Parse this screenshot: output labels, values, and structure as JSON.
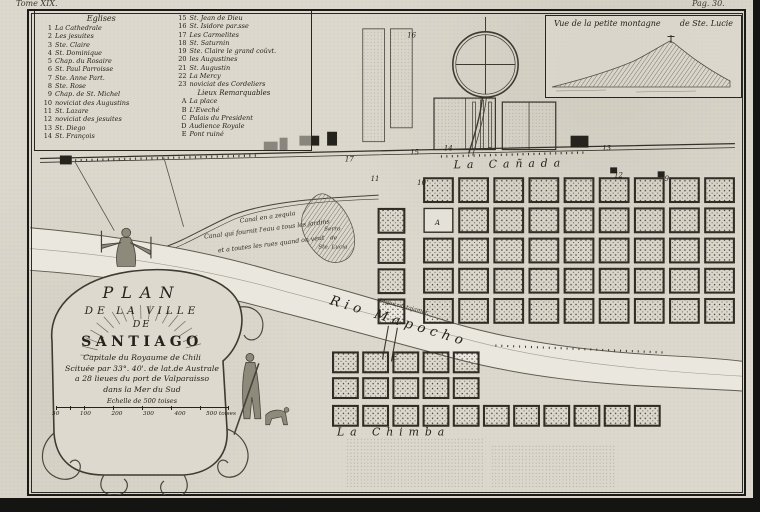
{
  "page": {
    "tome": "Tome XIX.",
    "page_ref": "Pag. 30."
  },
  "legend": {
    "title": "Eglises",
    "col1": [
      {
        "n": "1",
        "label": "La Cathedrale"
      },
      {
        "n": "2",
        "label": "Les jesuites"
      },
      {
        "n": "3",
        "label": "Ste. Claire"
      },
      {
        "n": "4",
        "label": "St. Dominique"
      },
      {
        "n": "5",
        "label": "Chap. du Rosaire"
      },
      {
        "n": "6",
        "label": "St. Paul Parroisse"
      },
      {
        "n": "7",
        "label": "Ste. Anne Part."
      },
      {
        "n": "8",
        "label": "Ste. Rose"
      },
      {
        "n": "9",
        "label": "Chap. de St. Michel"
      },
      {
        "n": "10",
        "label": "noviciat des Augustins"
      },
      {
        "n": "11",
        "label": "St. Lazare"
      },
      {
        "n": "12",
        "label": "noviciat des jesuites"
      },
      {
        "n": "13",
        "label": "St. Diego"
      },
      {
        "n": "14",
        "label": "St. François"
      }
    ],
    "col2": [
      {
        "n": "15",
        "label": "St. Jean de Dieu"
      },
      {
        "n": "16",
        "label": "St. Isidore par.sse"
      },
      {
        "n": "17",
        "label": "Les Carmelites"
      },
      {
        "n": "18",
        "label": "St. Saturnin"
      },
      {
        "n": "19",
        "label": "Ste. Claire le grand coûvt."
      },
      {
        "n": "20",
        "label": "les Augustines"
      },
      {
        "n": "21",
        "label": "St. Augustin"
      },
      {
        "n": "22",
        "label": "La Mercy"
      },
      {
        "n": "23",
        "label": "noviciat des Cordeliers"
      }
    ],
    "subtitle": "Lieux Remarquables",
    "col2b": [
      {
        "n": "A",
        "label": "La place"
      },
      {
        "n": "B",
        "label": "L'Eveché"
      },
      {
        "n": "C",
        "label": "Palais du President"
      },
      {
        "n": "D",
        "label": "Audience Royale"
      },
      {
        "n": "E",
        "label": "Pont ruiné"
      }
    ]
  },
  "inset": {
    "title_left": "Vue de la petite montagne",
    "title_right": "de Ste. Lucie"
  },
  "cartouche": {
    "line1": "PLAN",
    "line2": "DE LA VILLE",
    "line3": "DE",
    "line4": "SANTIAGO",
    "line5": "Capitale du Royaume de Chili",
    "line6": "Scituée par 33°. 40'. de lat.de Australe",
    "line7": "a 28 lieues du port de Valparaisso",
    "line8": "dans la Mer du Sud",
    "scale_title": "Echelle de 500 toises",
    "scale_ticks": [
      "50",
      "100",
      "200",
      "300",
      "400",
      "500 toises"
    ]
  },
  "map": {
    "labels": {
      "la_canada": "La Cañada",
      "rio_mapocho": "Rio Mapocho",
      "la_chimba": "La Chimba",
      "serro1": "Serro",
      "serro2": "de",
      "serro3": "Ste. Lucia",
      "canal1": "Canal en a zequia",
      "canal2": "Canal qui fournit l'eau a tous les jardins",
      "canal3": "et a toutes les rues quand on veut",
      "tajamar": "Digue ou tajamar"
    },
    "markers": [
      {
        "t": "17",
        "x": 318,
        "y": 152
      },
      {
        "t": "15",
        "x": 384,
        "y": 145
      },
      {
        "t": "14",
        "x": 418,
        "y": 141
      },
      {
        "t": "16",
        "x": 381,
        "y": 27
      },
      {
        "t": "13",
        "x": 578,
        "y": 141
      },
      {
        "t": "12",
        "x": 590,
        "y": 168
      },
      {
        "t": "9",
        "x": 641,
        "y": 172
      },
      {
        "t": "11",
        "x": 344,
        "y": 172
      },
      {
        "t": "10",
        "x": 391,
        "y": 176
      },
      {
        "t": "A",
        "x": 409,
        "y": 216
      },
      {
        "t": "E",
        "x": 366,
        "y": 352
      }
    ],
    "grids": [
      {
        "x": 398,
        "y": 169,
        "cols": 9,
        "rows": 5,
        "w": 29,
        "h": 24,
        "px": 35.5,
        "py": 30.5,
        "empty": [
          [
            1,
            0
          ]
        ]
      },
      {
        "x": 352,
        "y": 200,
        "cols": 1,
        "rows": 4,
        "w": 26,
        "h": 24,
        "px": 35.5,
        "py": 30.5,
        "empty": []
      },
      {
        "x": 306,
        "y": 345,
        "cols": 5,
        "rows": 2,
        "w": 25,
        "h": 20,
        "px": 30.5,
        "py": 26,
        "empty": []
      },
      {
        "x": 306,
        "y": 399,
        "cols": 11,
        "rows": 1,
        "w": 25,
        "h": 20,
        "px": 30.5,
        "py": 26,
        "empty": []
      }
    ]
  }
}
